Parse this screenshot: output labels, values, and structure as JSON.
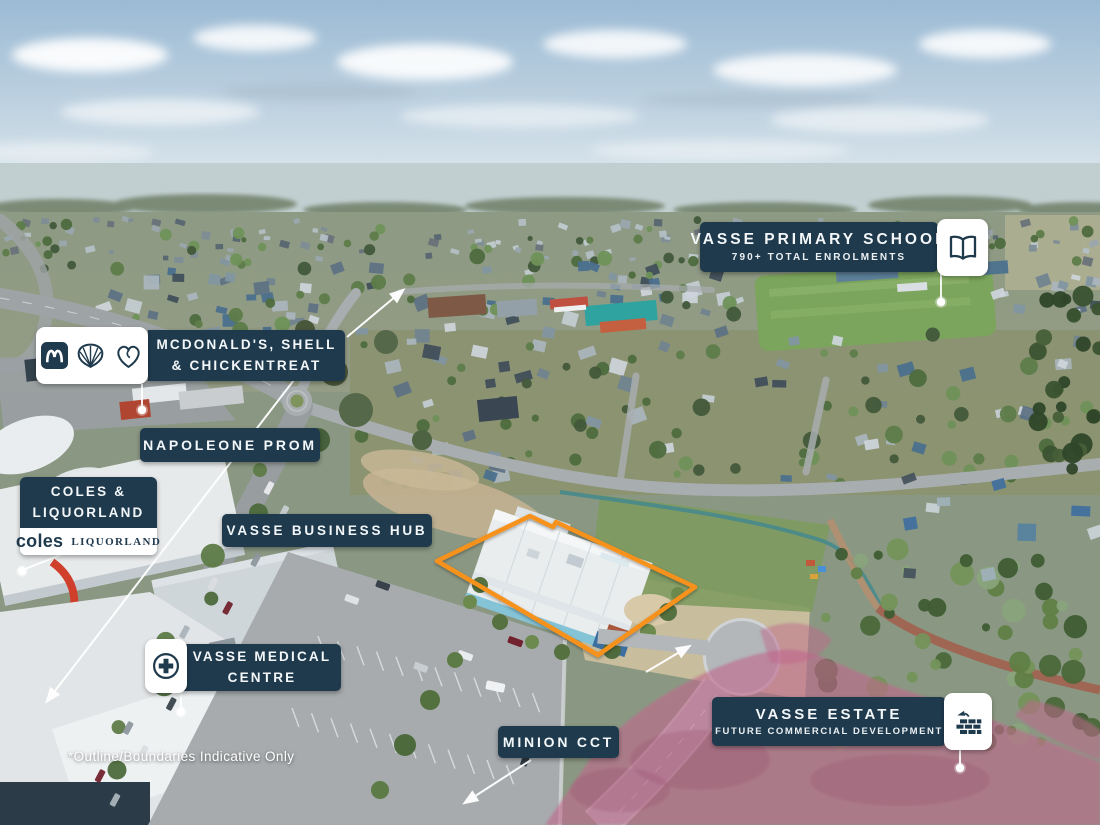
{
  "annotations": {
    "primary_school": {
      "title": "VASSE PRIMARY SCHOOL",
      "subtitle": "790+ TOTAL ENROLMENTS",
      "icon": "open-book-icon"
    },
    "fast_food": {
      "line1": "MCDONALD'S, SHELL",
      "line2": "& CHICKENTREAT",
      "icons": [
        "mcdonalds-arches-icon",
        "shell-icon",
        "chickentreat-heart-icon"
      ]
    },
    "napoleone_prom": {
      "title": "NAPOLEONE PROM"
    },
    "coles_liquorland": {
      "line1": "COLES &",
      "line2": "LIQUORLAND",
      "coles_logo": "coles",
      "liquorland_logo": "LIQUORLAND"
    },
    "business_hub": {
      "title": "VASSE BUSINESS HUB"
    },
    "medical_centre": {
      "line1": "VASSE MEDICAL",
      "line2": "CENTRE",
      "icon": "medical-cross-icon"
    },
    "minion_cct": {
      "title": "MINION CCT"
    },
    "vasse_estate": {
      "title": "VASSE ESTATE",
      "subtitle": "FUTURE COMMERCIAL DEVELOPMENT",
      "icon": "construction-bricks-icon"
    }
  },
  "footnote": {
    "text": "*Outline/Boundaries Indicative Only"
  },
  "colors": {
    "label_navy": "#1f3a4d",
    "label_text": "#f3f7f9",
    "boundary_orange": "#f6921e",
    "future_dev_pink": "#c0688c",
    "white_box": "#ffffff"
  }
}
